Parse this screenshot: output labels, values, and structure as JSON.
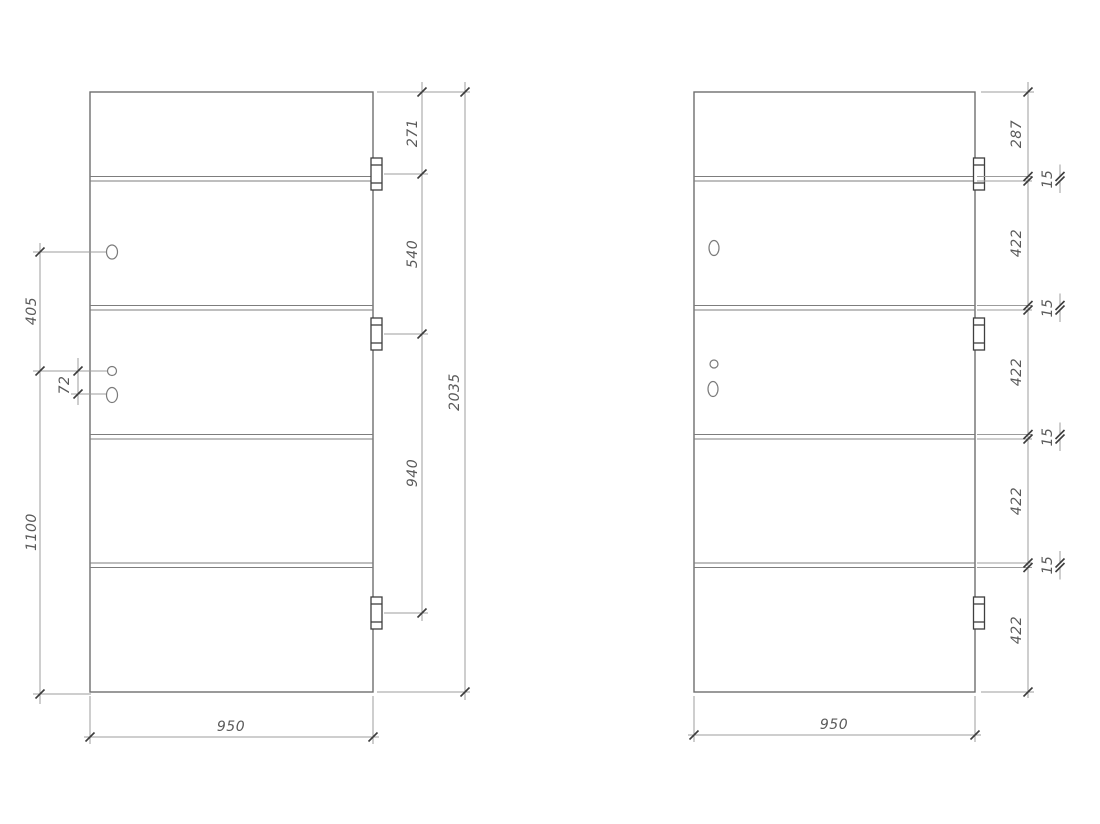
{
  "colors": {
    "background": "#ffffff",
    "drawing_lines": "#6e6e6e",
    "seam_lines": "#7d7d7d",
    "dimension_lines": "#9c9c9c",
    "tick_marks": "#3c3c3c",
    "dimension_text": "#5a5a5a"
  },
  "left_drawing": {
    "width_label": "950",
    "height_label": "2035",
    "hinge_dims": [
      "271",
      "540",
      "940"
    ],
    "hole_dims": [
      "405",
      "72",
      "1100"
    ]
  },
  "right_drawing": {
    "width_label": "950",
    "height_segments": [
      "287",
      "15",
      "422",
      "15",
      "422",
      "15",
      "422",
      "15",
      "422"
    ]
  }
}
